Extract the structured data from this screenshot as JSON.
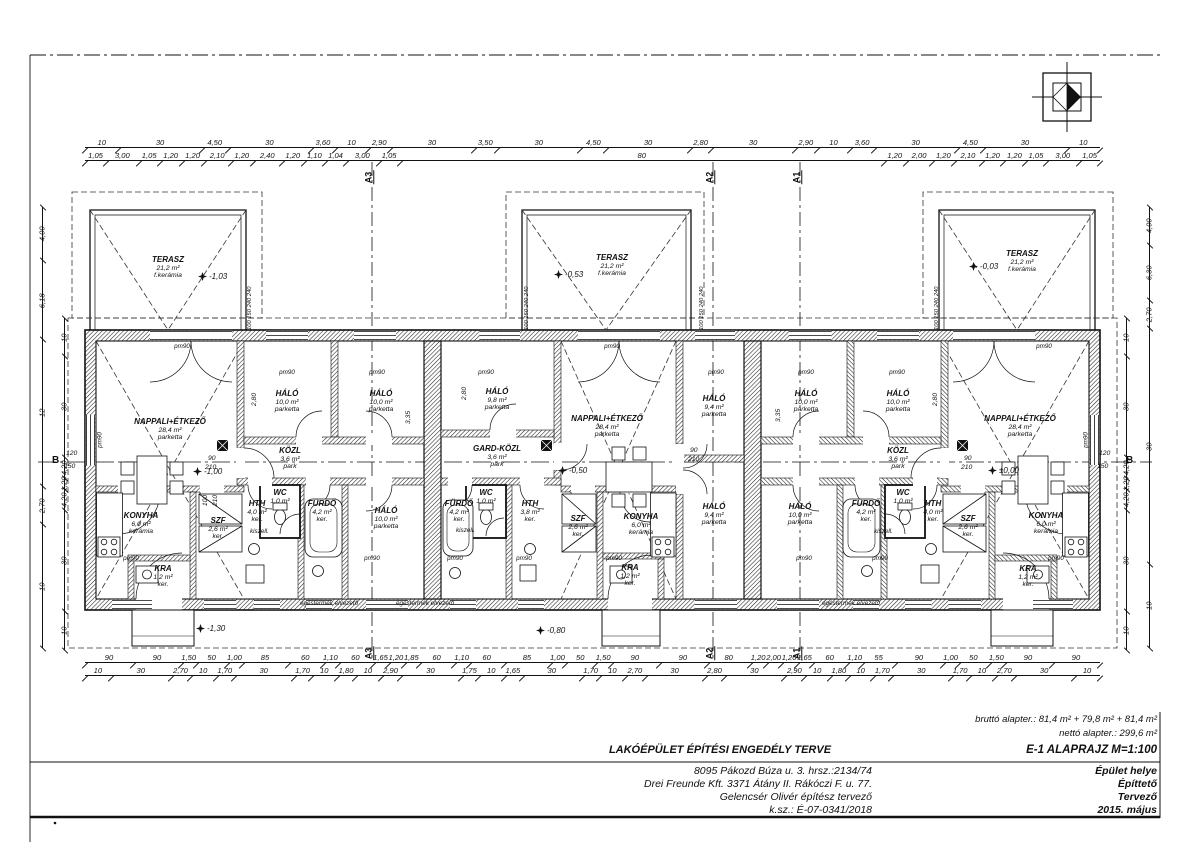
{
  "sheet": {
    "project_title": "LAKÓÉPÜLET ÉPÍTÉSI ENGEDÉLY TERVE",
    "sheet_title": "E-1  ALAPRAJZ M=1:100",
    "area_gross": "bruttó alapter.: 81,4 m² + 79,8 m² + 81,4 m²",
    "area_net": "nettó alapter.: 299,6 m²",
    "title_rows": [
      {
        "value": "8095 Pákozd Búza u. 3. hrsz.:2134/74",
        "label": "Épület helye"
      },
      {
        "value": "Drei Freunde Kft. 3371 Átány II. Rákóczi F. u. 77.",
        "label": "Építtető"
      },
      {
        "value": "Gelencsér Olivér  építész tervező",
        "label": "Tervező"
      },
      {
        "value": "k.sz.: É-07-0341/2018",
        "label": "2015. május"
      }
    ]
  },
  "rooms": [
    {
      "unit": 1,
      "name": "TERASZ",
      "area": "21,2 m²",
      "floor": "f.kerámia"
    },
    {
      "unit": 1,
      "name": "NAPPALI+ÉTKEZŐ",
      "area": "28,4 m²",
      "floor": "parketta"
    },
    {
      "unit": 1,
      "name": "HÁLÓ",
      "area": "10,0 m²",
      "floor": "parketta"
    },
    {
      "unit": 1,
      "name": "HÁLÓ",
      "area": "10,0 m²",
      "floor": "parketta"
    },
    {
      "unit": 1,
      "name": "KÖZL",
      "area": "3,6 m²",
      "floor": "park"
    },
    {
      "unit": 1,
      "name": "HTH",
      "area": "4,0 m²",
      "floor": "ker."
    },
    {
      "unit": 1,
      "name": "WC",
      "area": "1,0 m²",
      "floor": ""
    },
    {
      "unit": 1,
      "name": "FÜRDŐ",
      "area": "4,2 m²",
      "floor": "ker."
    },
    {
      "unit": 1,
      "name": "HÁLÓ",
      "area": "10,0 m²",
      "floor": "parketta"
    },
    {
      "unit": 1,
      "name": "KONYHA",
      "area": "6,0 m²",
      "floor": "kerámia"
    },
    {
      "unit": 1,
      "name": "SZF",
      "area": "2,6 m²",
      "floor": "ker."
    },
    {
      "unit": 1,
      "name": "KRA",
      "area": "1,2 m²",
      "floor": "ker."
    },
    {
      "unit": 2,
      "name": "TERASZ",
      "area": "21,2 m²",
      "floor": "f.kerámia"
    },
    {
      "unit": 2,
      "name": "NAPPALI+ÉTKEZŐ",
      "area": "28,4 m²",
      "floor": "parketta"
    },
    {
      "unit": 2,
      "name": "HÁLÓ",
      "area": "9,8 m²",
      "floor": "parketta"
    },
    {
      "unit": 2,
      "name": "GARD-KÖZL",
      "area": "3,6 m²",
      "floor": "park"
    },
    {
      "unit": 2,
      "name": "FÜRDŐ",
      "area": "4,2 m²",
      "floor": "ker."
    },
    {
      "unit": 2,
      "name": "WC",
      "area": "1,0 m²",
      "floor": ""
    },
    {
      "unit": 2,
      "name": "HTH",
      "area": "3,8 m²",
      "floor": "ker."
    },
    {
      "unit": 2,
      "name": "HÁLÓ",
      "area": "9,4 m²",
      "floor": "parketta"
    },
    {
      "unit": 2,
      "name": "HÁLÓ",
      "area": "9,4 m²",
      "floor": "parketta"
    },
    {
      "unit": 2,
      "name": "SZF",
      "area": "2,6 m²",
      "floor": "ker."
    },
    {
      "unit": 2,
      "name": "KONYHA",
      "area": "6,0 m²",
      "floor": "kerámia"
    },
    {
      "unit": 2,
      "name": "KRA",
      "area": "1,2 m²",
      "floor": "ker."
    },
    {
      "unit": 3,
      "name": "TERASZ",
      "area": "21,2 m²",
      "floor": "f.kerámia"
    },
    {
      "unit": 3,
      "name": "NAPPALI+ÉTKEZŐ",
      "area": "28,4 m²",
      "floor": "parketta"
    },
    {
      "unit": 3,
      "name": "HÁLÓ",
      "area": "10,0 m²",
      "floor": "parketta"
    },
    {
      "unit": 3,
      "name": "HÁLÓ",
      "area": "10,0 m²",
      "floor": "parketta"
    },
    {
      "unit": 3,
      "name": "KÖZL",
      "area": "3,6 m²",
      "floor": "park"
    },
    {
      "unit": 3,
      "name": "HÁLÓ",
      "area": "10,0 m²",
      "floor": "parketta"
    },
    {
      "unit": 3,
      "name": "FÜRDŐ",
      "area": "4,2 m²",
      "floor": "ker."
    },
    {
      "unit": 3,
      "name": "WC",
      "area": "1,0 m²",
      "floor": ""
    },
    {
      "unit": 3,
      "name": "HTH",
      "area": "4,0 m²",
      "floor": "ker."
    },
    {
      "unit": 3,
      "name": "SZF",
      "area": "2,6 m²",
      "floor": "ker."
    },
    {
      "unit": 3,
      "name": "KONYHA",
      "area": "6,0 m²",
      "floor": "kerámia"
    },
    {
      "unit": 3,
      "name": "KRA",
      "area": "1,2 m²",
      "floor": "ker."
    }
  ],
  "levels": [
    "-1,03",
    "-0,53",
    "-0,03",
    "-1,00",
    "-0,50",
    "±0,00",
    "-1,30",
    "-0,80"
  ],
  "sections": [
    "A3",
    "A2",
    "A1"
  ],
  "axis": {
    "label": "B",
    "offset_top": "120",
    "offset_bottom": "150"
  },
  "annotations": {
    "pm": "pm90",
    "kiszell": "kiszell.",
    "flue": "égéstermék elvezető",
    "terasz_col": "100 150 240 240"
  },
  "interior_dims": [
    "2,80",
    "3,35",
    "2,80",
    "3,35",
    "2,80",
    "90",
    "210",
    "90",
    "210",
    "90",
    "210",
    "100",
    "210"
  ],
  "dims": {
    "top1": [
      "10",
      "30",
      "4,50",
      "30",
      "3,60",
      "10",
      "2,90",
      "30",
      "3,50",
      "30",
      "4,50",
      "30",
      "2,80",
      "30",
      "2,90",
      "10",
      "3,60",
      "30",
      "4,50",
      "30",
      "10"
    ],
    "top2": [
      "1,05",
      "3,00",
      "1,05",
      "1,20",
      "1,20",
      "2,10",
      "1,20",
      "2,40",
      "1,20",
      "1,10",
      "1,04",
      "3,00",
      "1,05",
      "80",
      "1,20",
      "2,00",
      "1,20",
      "2,10",
      "1,20",
      "1,20",
      "1,05",
      "3,00",
      "1,05"
    ],
    "bottom1": [
      "90",
      "90",
      "1,50",
      "50",
      "1,00",
      "85",
      "60",
      "1,10",
      "60",
      "1,65",
      "1,20",
      "1,85",
      "60",
      "1,10",
      "60",
      "85",
      "1,00",
      "50",
      "1,50",
      "90",
      "90",
      "80",
      "1,20",
      "2,00",
      "1,20",
      "1,65",
      "60",
      "1,10",
      "55",
      "90",
      "1,00",
      "50",
      "1,50",
      "90",
      "90"
    ],
    "bottom2": [
      "10",
      "30",
      "2,70",
      "10",
      "1,70",
      "30",
      "1,70",
      "10",
      "1,80",
      "10",
      "2,90",
      "30",
      "1,75",
      "10",
      "1,65",
      "30",
      "1,70",
      "10",
      "2,70",
      "30",
      "2,80",
      "30",
      "2,90",
      "10",
      "1,80",
      "10",
      "1,70",
      "30",
      "1,70",
      "10",
      "2,70",
      "30",
      "10"
    ],
    "left_outer": [
      "4,00",
      "6,18",
      "12",
      "2,70",
      "10"
    ],
    "left_inner": [
      "10",
      "30",
      "4,20",
      "1,20",
      "4,20",
      "30",
      "10"
    ],
    "right_outer": [
      "4,00",
      "6,30",
      "2,70",
      "30",
      "10"
    ],
    "right_inner": [
      "10",
      "30",
      "4,20",
      "1,20",
      "4,20",
      "30",
      "10"
    ]
  }
}
